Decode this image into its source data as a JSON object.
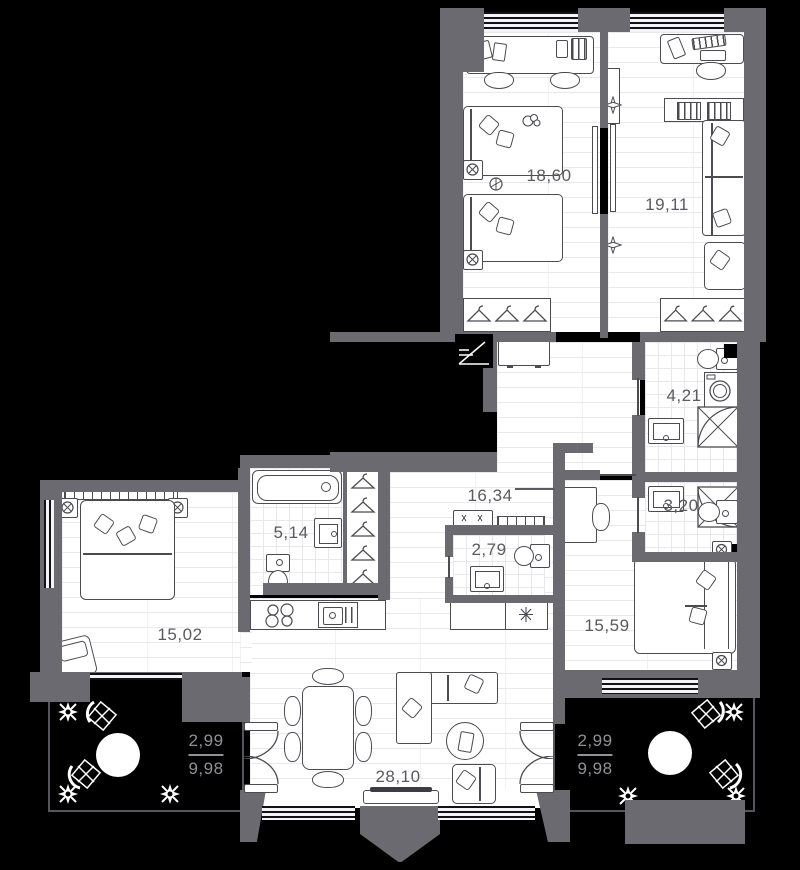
{
  "plan": {
    "rooms": [
      {
        "name": "bedroom-top-left",
        "area": "18,60"
      },
      {
        "name": "room-top-right",
        "area": "19,11"
      },
      {
        "name": "bathroom-large",
        "area": "4,21"
      },
      {
        "name": "shower-room",
        "area": "3,20"
      },
      {
        "name": "hallway",
        "area": "16,34"
      },
      {
        "name": "bathroom-small",
        "area": "5,14"
      },
      {
        "name": "wc",
        "area": "2,79"
      },
      {
        "name": "bedroom-left",
        "area": "15,02"
      },
      {
        "name": "bedroom-right",
        "area": "15,59"
      },
      {
        "name": "living-kitchen",
        "area": "28,10"
      }
    ],
    "balconies": [
      {
        "name": "balcony-left",
        "area_reduced": "2,99",
        "area_full": "9,98"
      },
      {
        "name": "balcony-right",
        "area_reduced": "2,99",
        "area_full": "9,98"
      }
    ],
    "colors": {
      "background": "#000000",
      "wall": "#6a6a70",
      "floor": "#ffffff",
      "floor_line": "#e9e9ed",
      "furniture_outline": "#4b4b52",
      "label_text": "#5a5a60",
      "balcony_label_text": "#909095"
    }
  }
}
